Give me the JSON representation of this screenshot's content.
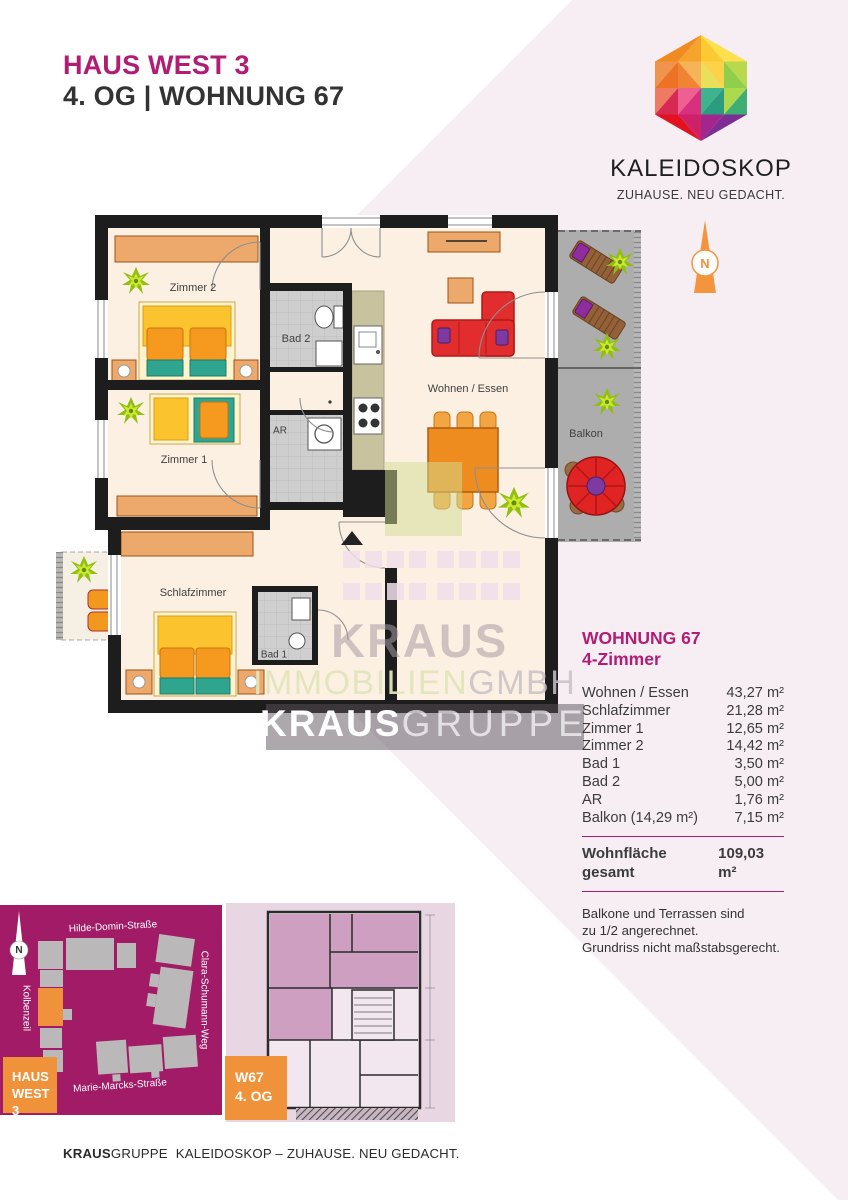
{
  "header": {
    "house": "HAUS WEST 3",
    "unit_line": "4. OG | WOHNUNG 67"
  },
  "brand": {
    "logo_text": "KALEIDOSKOP",
    "tagline": "ZUHAUSE. NEU GEDACHT.",
    "compass_letter": "N"
  },
  "floor_plan": {
    "labels": {
      "zimmer2": "Zimmer 2",
      "zimmer1": "Zimmer 1",
      "schlafzimmer": "Schlafzimmer",
      "wohnen_essen": "Wohnen / Essen",
      "balkon": "Balkon",
      "bad1": "Bad 1",
      "bad2": "Bad 2",
      "ar": "AR"
    }
  },
  "watermark": {
    "kraus": "KRAUS",
    "immobilien": "IMMOBILIEN",
    "gmbh": "GMBH",
    "gruppe_bold": "KRAUS",
    "gruppe_light": "GRUPPE"
  },
  "details": {
    "title": "WOHNUNG 67",
    "subtitle": "4-Zimmer",
    "rows": [
      {
        "label": "Wohnen / Essen",
        "value": "43,27 m²"
      },
      {
        "label": "Schlafzimmer",
        "value": "21,28 m²"
      },
      {
        "label": "Zimmer 1",
        "value": "12,65 m²"
      },
      {
        "label": "Zimmer 2",
        "value": "14,42 m²"
      },
      {
        "label": "Bad 1",
        "value": "3,50 m²"
      },
      {
        "label": "Bad 2",
        "value": "5,00 m²"
      },
      {
        "label": "AR",
        "value": "1,76 m²"
      },
      {
        "label": "Balkon (14,29 m²)",
        "value": "7,15 m²"
      }
    ],
    "total_label": "Wohnfläche gesamt",
    "total_value": "109,03 m²",
    "notes": [
      "Balkone und Terrassen sind",
      "zu 1/2 angerechnet.",
      "Grundriss nicht maßstabsgerecht."
    ]
  },
  "site_map": {
    "streets": [
      "Hilde-Domin-Straße",
      "Clara-Schumann-Weg",
      "Kolbenzeil",
      "Marie-Marcks-Straße"
    ],
    "badge": {
      "line1": "HAUS",
      "line2": "WEST 3"
    },
    "compass_letter": "N"
  },
  "mini_plan": {
    "badge": {
      "line1": "W67",
      "line2": "4. OG"
    }
  },
  "footer": {
    "part1": "KRAUS",
    "part2": "GRUPPE",
    "part3": "KALEIDOSKOP – ZUHAUSE. NEU GEDACHT."
  },
  "colors": {
    "brand_magenta": "#b21d74",
    "accent_orange": "#f0923a",
    "map_magenta": "#a11b66",
    "background_pink": "#f7eef4",
    "plan_floor": "#fcf0e2",
    "plan_wall": "#1d1d1d"
  }
}
